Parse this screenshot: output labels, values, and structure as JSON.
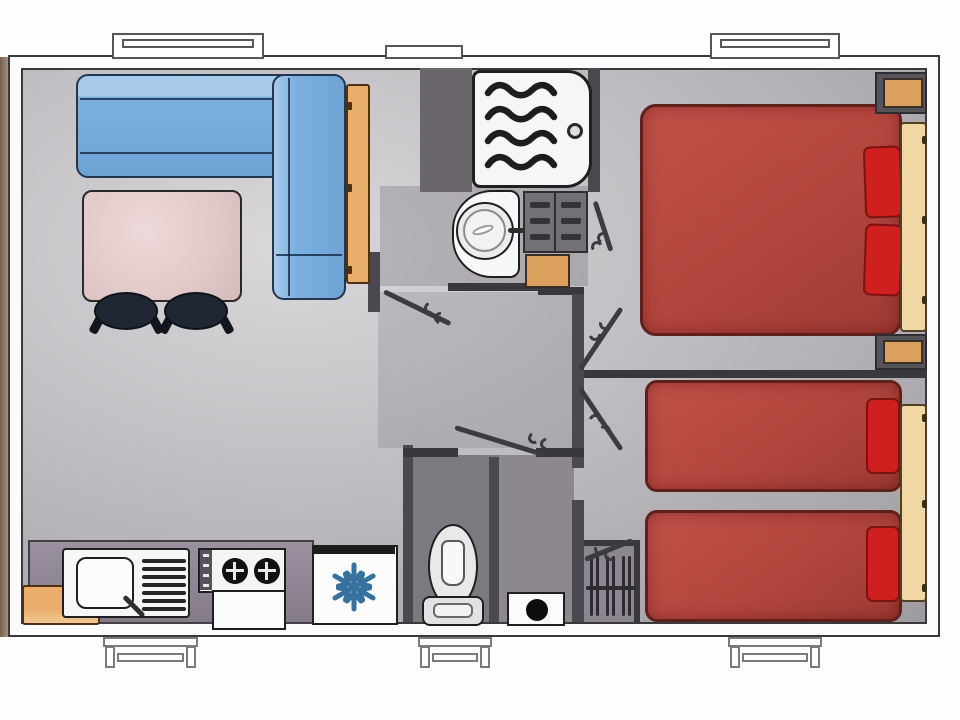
{
  "floor_plan": {
    "kind": "mobile-home top-view floor plan",
    "exterior": {
      "windows_top_wall": 2,
      "roof_vent_top_wall": 1,
      "entry_steps_bottom_wall": 3,
      "deck_edge_left": true
    },
    "palette": {
      "floor_gray": "#bdbbbf",
      "wall_gray": "#4b4950",
      "sofa_blue": "#7cb0e0",
      "wood_tan": "#e9ad6c",
      "table_pink": "#e2cbca",
      "bed_red": "#b2453d",
      "pillow_red": "#d01f1f",
      "headboard_tan": "#f1d7a3",
      "snowflake_blue": "#36719f"
    },
    "rooms": [
      {
        "name": "living-dining",
        "furniture": [
          "corner-sofa-blue",
          "tall-wardrobe",
          "dining-table",
          "stool",
          "stool"
        ]
      },
      {
        "name": "kitchen",
        "furniture": [
          "storage-bench",
          "sink-with-drainer",
          "two-burner-hob-with-oven",
          "fridge-freezer"
        ]
      },
      {
        "name": "shower-room",
        "furniture": [
          "shower-tray",
          "washbasin",
          "drawer-cabinet",
          "storage-cube"
        ]
      },
      {
        "name": "wc",
        "furniture": [
          "toilet"
        ]
      },
      {
        "name": "technical-corner",
        "furniture": [
          "water-heater",
          "slatted-closet"
        ]
      },
      {
        "name": "bedroom-double",
        "furniture": [
          "double-bed",
          "pillow",
          "pillow",
          "headboard",
          "nightstand",
          "nightstand"
        ]
      },
      {
        "name": "bedroom-twin",
        "furniture": [
          "single-bed",
          "single-bed",
          "pillow",
          "pillow",
          "shared-headboard"
        ]
      },
      {
        "name": "hallway",
        "furniture": []
      }
    ],
    "door_swings": [
      "hallway-door",
      "bedroom-double-door",
      "bedroom-twin-door",
      "wc-door",
      "closet-door",
      "shower-room-door"
    ]
  },
  "icons": {
    "fridge": "snowflake-icon",
    "shower": "wavy-water-lines-icon",
    "shower_drain": "drain-circle-icon"
  }
}
